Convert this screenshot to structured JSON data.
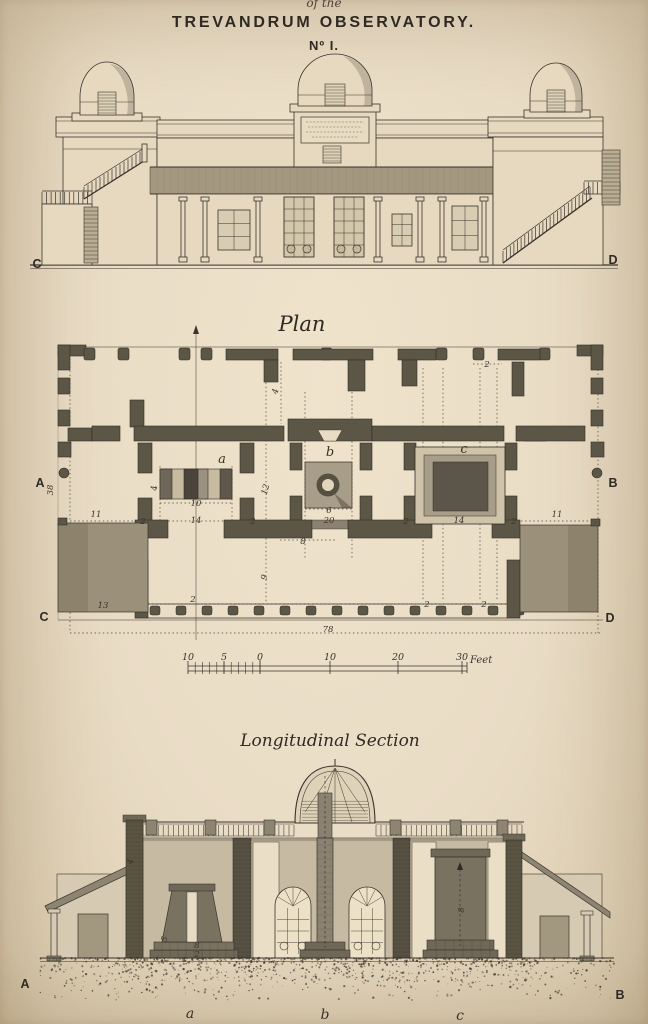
{
  "plate": {
    "pretitle": "of the",
    "title": "TREVANDRUM OBSERVATORY.",
    "number": "Nº I."
  },
  "elevation": {
    "corner_left": "C",
    "corner_right": "D"
  },
  "plan": {
    "caption": "Plan",
    "corner_letters": {
      "mid_left": "A",
      "mid_right": "B",
      "bottom_left": "C",
      "bottom_right": "D"
    },
    "room_labels": [
      {
        "t": "a",
        "x": 222,
        "y": 463
      },
      {
        "t": "b",
        "x": 330,
        "y": 456
      },
      {
        "t": "c",
        "x": 464,
        "y": 453
      }
    ],
    "dims": [
      {
        "t": "38",
        "x": 53,
        "y": 490,
        "r": -90
      },
      {
        "t": "11",
        "x": 96,
        "y": 517
      },
      {
        "t": "2",
        "x": 143,
        "y": 524
      },
      {
        "t": "14",
        "x": 196,
        "y": 523
      },
      {
        "t": "2",
        "x": 253,
        "y": 524
      },
      {
        "t": "20",
        "x": 329,
        "y": 523
      },
      {
        "t": "2",
        "x": 406,
        "y": 524
      },
      {
        "t": "14",
        "x": 459,
        "y": 523
      },
      {
        "t": "2",
        "x": 514,
        "y": 524
      },
      {
        "t": "11",
        "x": 557,
        "y": 517
      },
      {
        "t": "13",
        "x": 103,
        "y": 608
      },
      {
        "t": "9",
        "x": 267,
        "y": 578,
        "r": -75
      },
      {
        "t": "8",
        "x": 303,
        "y": 544
      },
      {
        "t": "2",
        "x": 193,
        "y": 602
      },
      {
        "t": "2",
        "x": 427,
        "y": 607
      },
      {
        "t": "2",
        "x": 484,
        "y": 607
      },
      {
        "t": "78",
        "x": 328,
        "y": 632
      },
      {
        "t": "4",
        "x": 157,
        "y": 488,
        "r": -90
      },
      {
        "t": "10",
        "x": 196,
        "y": 506
      },
      {
        "t": "12",
        "x": 268,
        "y": 490,
        "r": -75
      },
      {
        "t": "6",
        "x": 329,
        "y": 513
      },
      {
        "t": "4",
        "x": 278,
        "y": 392,
        "r": -75
      },
      {
        "t": "2",
        "x": 487,
        "y": 367
      }
    ]
  },
  "scale_bar": {
    "unit_label": "Feet",
    "labels": [
      {
        "t": "10",
        "x": 188,
        "y": 660
      },
      {
        "t": "5",
        "x": 224,
        "y": 660
      },
      {
        "t": "0",
        "x": 260,
        "y": 660
      },
      {
        "t": "10",
        "x": 330,
        "y": 660
      },
      {
        "t": "20",
        "x": 398,
        "y": 660
      },
      {
        "t": "30",
        "x": 462,
        "y": 660
      }
    ]
  },
  "section": {
    "caption": "Longitudinal Section",
    "corner_left": "A",
    "corner_right": "B",
    "pier_labels": [
      {
        "t": "a",
        "x": 190,
        "y": 1018
      },
      {
        "t": "b",
        "x": 325,
        "y": 1019
      },
      {
        "t": "c",
        "x": 460,
        "y": 1020
      }
    ],
    "marks": [
      {
        "t": "5",
        "x": 167,
        "y": 940,
        "r": -70
      },
      {
        "t": "8",
        "x": 197,
        "y": 948
      },
      {
        "t": "2",
        "x": 197,
        "y": 957
      },
      {
        "t": "8",
        "x": 464,
        "y": 910,
        "r": -90
      },
      {
        "t": "4",
        "x": 133,
        "y": 862,
        "r": -80
      }
    ]
  },
  "colors": {
    "paper": "#e9dcc5",
    "ink": "#3a342b",
    "wall_shade": "#a3987f",
    "plan_wall": "#5c5647",
    "terrace": "#9b9079"
  }
}
